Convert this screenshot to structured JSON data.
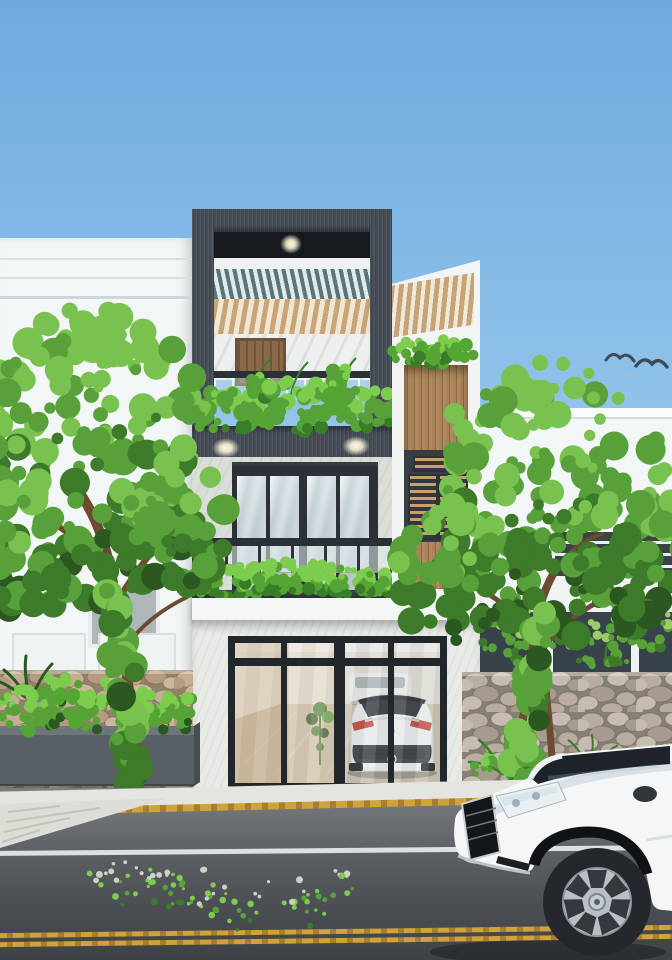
{
  "scene": {
    "title": "Daytime 3D exterior render of a modern three-storey narrow townhouse with roof terrace, timber screens, glazed garage, street trees and a passing white sedan",
    "objects": {
      "sky": "Clear blue sky",
      "birds": "Birds flying in the sky",
      "left_building": "Neighbouring white building on the left",
      "right_building": "Neighbouring white building on the right",
      "house": "Modern narrow townhouse with dark feature frame",
      "terrace": "Roof terrace framed in dark cladding with slatted pergola ceiling",
      "terrace_door": "Wooden door on the roof terrace",
      "terrace_plants": "Planter greenery on the terrace balcony edge",
      "pergola_rear": "Rear rooftop pergola with timber slats",
      "balcony": "First-floor balcony with glass railing and hedge planter",
      "glass_doors": "Dark-framed glass balcony doors",
      "wood_screen": "Vertical timber slat screen with louvred shutters",
      "garage": "Glazed garage door with dark aluminium frame",
      "garage_car": "White hatchback parked inside the garage",
      "garage_plant": "Potted plant inside the garage",
      "tree_left": "Leafy street tree on the left",
      "tree_right": "Leafy street tree on the right",
      "stone_wall_left": "Natural stone fence on the left",
      "stone_wall_right": "Natural stone fence on the right",
      "street_planter": "Concrete street planter with grasses",
      "sidewalk": "Sloping sidewalk curb",
      "street": "Asphalt street with lane markings",
      "lane_markings": "Yellow and white painted lane lines",
      "scattered_leaves": "Fallen leaves scattered on the asphalt",
      "sedan": "White sedan driving past in the foreground"
    }
  },
  "palette": {
    "sky_top": "#6fa9de",
    "sky_mid": "#8fc3ea",
    "sky_horizon": "#d8ecf6",
    "bird_dark": "#3c4a55",
    "bird_light": "#a9bcc8",
    "wall_white": "#f3f6f7",
    "frame_dark": "#464d57",
    "soffit_black": "#16191d",
    "slat_teal": "#5a767b",
    "wood_light": "#c9a476",
    "wood_dark": "#96714a",
    "marble": "#d9ded9",
    "glass_frame": "#2b3136",
    "glass_blue": "#c3d1d7",
    "rail_dark": "#2b3036",
    "planter_dark": "#363d43",
    "stone_mortar_warm": "#94816b",
    "stone_warm1": "#c4ae94",
    "stone_warm2": "#b39c82",
    "stone_warm3": "#cdb89e",
    "stone_mortar_cool": "#878074",
    "stone_cool1": "#b9ada1",
    "stone_cool2": "#c7bcb1",
    "stone_cool3": "#a79b8f",
    "planter_box": "#585f65",
    "trunk_brown": "#6d4b32",
    "leaf_dark": "#2b5721",
    "leaf_mid": "#3d7a2a",
    "leaf_light": "#58a039",
    "leaf_bright": "#79c24f",
    "hedge_dark": "#3a7d28",
    "hedge_mid": "#55a534",
    "hedge_bright": "#7ccc4e",
    "fern_light": "#9acc6a",
    "road_leaf_pale": "#ccd1c5",
    "road_mid": "#5c6064",
    "lane_yellow": "#cfa23c",
    "lane_white": "#e6eaea",
    "car_white": "#f4f6f7",
    "tire_dark": "#24272b",
    "glass_dark": "#1d2328",
    "taillight_red": "#c3392f"
  }
}
